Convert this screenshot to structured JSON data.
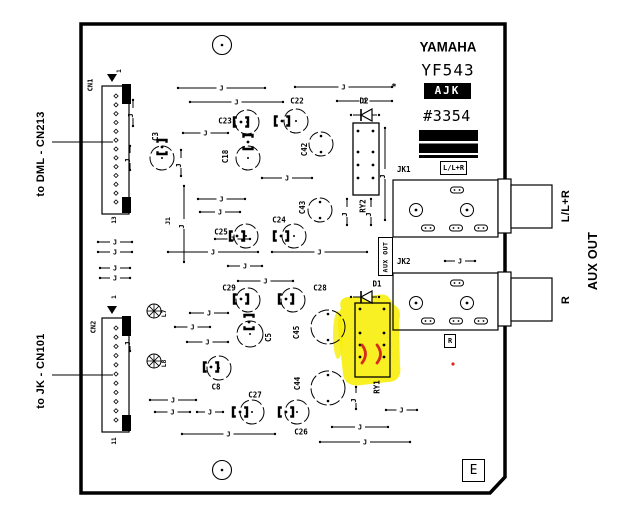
{
  "title_block": {
    "brand": "YAMAHA",
    "model": "YF543",
    "code": "AJK",
    "number": "#3354"
  },
  "board": {
    "revision": "E",
    "aux_out_box": "AUX OUT",
    "asterisk": "*"
  },
  "external_labels": {
    "left_top": "to DML - CN213",
    "left_bottom": "to JK - CN101",
    "right_jack1": "L/L+R",
    "right_jack2": "R",
    "right_group": "AUX OUT"
  },
  "jacks": [
    {
      "name": "JK1",
      "signal": "L/L+R",
      "x": 393,
      "y": 180,
      "w": 105,
      "h": 57
    },
    {
      "name": "JK2",
      "signal": "R",
      "x": 393,
      "y": 273,
      "w": 105,
      "h": 57
    }
  ],
  "connectors": [
    {
      "name": "CN1",
      "first_pin": "1",
      "last_pin": "13",
      "pins": 13,
      "x": 102,
      "y": 86,
      "w": 27,
      "h": 128
    },
    {
      "name": "CN2",
      "first_pin": "1",
      "last_pin": "11",
      "pins": 11,
      "x": 102,
      "y": 318,
      "w": 27,
      "h": 114
    }
  ],
  "relays": [
    {
      "label": "RY1",
      "x": 355,
      "y": 303,
      "w": 35,
      "h": 74,
      "cols": [
        360,
        384
      ],
      "rows": [
        309,
        333,
        345,
        357
      ]
    },
    {
      "label": "RY2",
      "x": 353,
      "y": 123,
      "w": 26,
      "h": 72,
      "cols": [
        358,
        373
      ],
      "rows": [
        131,
        152,
        165,
        178
      ]
    }
  ],
  "diodes": [
    {
      "label": "D1",
      "cx": 365,
      "cy": 297
    },
    {
      "label": "D2",
      "cx": 365,
      "cy": 115
    }
  ],
  "inductors": [
    {
      "label": "L7",
      "cx": 154,
      "cy": 311
    },
    {
      "label": "L8",
      "cx": 154,
      "cy": 361
    }
  ],
  "capacitors": [
    {
      "label": "C3",
      "cx": 162,
      "cy": 158,
      "r": 12,
      "lx": 158,
      "ly": 134,
      "lr": -90,
      "bx": 162,
      "by": 147,
      "br": 90,
      "d": "c"
    },
    {
      "label": "C23",
      "cx": 247,
      "cy": 122,
      "r": 12,
      "lx": 225,
      "ly": 121,
      "lr": 0,
      "bx": 241,
      "by": 122,
      "br": 0,
      "d": "c"
    },
    {
      "label": "C22",
      "cx": 296,
      "cy": 121,
      "r": 12,
      "lx": 297,
      "ly": 101,
      "lr": 0,
      "bx": 282,
      "by": 121,
      "br": 0,
      "d": "c"
    },
    {
      "label": "C18",
      "cx": 248,
      "cy": 158,
      "r": 12,
      "lx": 228,
      "ly": 154,
      "lr": -90,
      "bx": 248,
      "by": 142,
      "br": 90,
      "d": "c"
    },
    {
      "label": "C42",
      "cx": 321,
      "cy": 144,
      "r": 12,
      "lx": 307,
      "ly": 147,
      "lr": -90,
      "d": "tb"
    },
    {
      "label": "C24",
      "cx": 294,
      "cy": 236,
      "r": 12,
      "lx": 279,
      "ly": 220,
      "lr": 0,
      "bx": 281,
      "by": 236,
      "br": 0,
      "d": "c"
    },
    {
      "label": "C25",
      "cx": 246,
      "cy": 236,
      "r": 12,
      "lx": 221,
      "ly": 232,
      "lr": 0,
      "bx": 237,
      "by": 236,
      "br": 0,
      "d": "c"
    },
    {
      "label": "C43",
      "cx": 320,
      "cy": 210,
      "r": 12,
      "lx": 305,
      "ly": 205,
      "lr": -90,
      "d": "tb"
    },
    {
      "label": "C29",
      "cx": 248,
      "cy": 300,
      "r": 12,
      "lx": 229,
      "ly": 288,
      "lr": 0,
      "bx": 241,
      "by": 299,
      "br": 0,
      "d": "c"
    },
    {
      "label": "C28",
      "cx": 293,
      "cy": 300,
      "r": 12,
      "lx": 320,
      "ly": 288,
      "lr": 0,
      "bx": 286,
      "by": 299,
      "br": 0,
      "d": "c"
    },
    {
      "label": "C5",
      "cx": 250,
      "cy": 334,
      "r": 13,
      "lx": 271,
      "ly": 335,
      "lr": -90,
      "bx": 249,
      "by": 322,
      "br": 90,
      "d": "c"
    },
    {
      "label": "C45",
      "cx": 328,
      "cy": 327,
      "r": 17,
      "lx": 299,
      "ly": 330,
      "lr": -90,
      "d": "tb"
    },
    {
      "label": "C8",
      "cx": 219,
      "cy": 368,
      "r": 12,
      "lx": 216,
      "ly": 387,
      "lr": 0,
      "bx": 211,
      "by": 367,
      "br": 0,
      "d": "c"
    },
    {
      "label": "C27",
      "cx": 252,
      "cy": 412,
      "r": 12,
      "lx": 255,
      "ly": 395,
      "lr": 0,
      "bx": 240,
      "by": 412,
      "br": 0,
      "d": "c"
    },
    {
      "label": "C26",
      "cx": 297,
      "cy": 412,
      "r": 12,
      "lx": 301,
      "ly": 432,
      "lr": 0,
      "bx": 286,
      "by": 412,
      "br": 0,
      "d": "c"
    },
    {
      "label": "C44",
      "cx": 328,
      "cy": 388,
      "r": 17,
      "lx": 300,
      "ly": 381,
      "lr": -90,
      "d": "tb"
    }
  ],
  "jumper_glyph": "J",
  "wire": {
    "j1": "J1"
  },
  "jumpers": [
    {
      "o": "h",
      "x1": 178,
      "x2": 265,
      "y": 88
    },
    {
      "o": "h",
      "x1": 295,
      "x2": 392,
      "y": 87
    },
    {
      "o": "h",
      "x1": 190,
      "x2": 283,
      "y": 102
    },
    {
      "o": "h",
      "x1": 337,
      "x2": 392,
      "y": 101
    },
    {
      "o": "h",
      "x1": 183,
      "x2": 228,
      "y": 133
    },
    {
      "o": "h",
      "x1": 262,
      "x2": 312,
      "y": 178
    },
    {
      "o": "h",
      "x1": 198,
      "x2": 245,
      "y": 199
    },
    {
      "o": "h",
      "x1": 200,
      "x2": 240,
      "y": 212
    },
    {
      "o": "h",
      "x1": 215,
      "x2": 250,
      "y": 239
    },
    {
      "o": "h",
      "x1": 168,
      "x2": 258,
      "y": 252
    },
    {
      "o": "h",
      "x1": 272,
      "x2": 367,
      "y": 252
    },
    {
      "o": "h",
      "x1": 228,
      "x2": 262,
      "y": 266
    },
    {
      "o": "h",
      "x1": 238,
      "x2": 293,
      "y": 281
    },
    {
      "o": "h",
      "x1": 98,
      "x2": 132,
      "y": 242
    },
    {
      "o": "h",
      "x1": 98,
      "x2": 132,
      "y": 252
    },
    {
      "o": "h",
      "x1": 100,
      "x2": 130,
      "y": 268
    },
    {
      "o": "h",
      "x1": 100,
      "x2": 130,
      "y": 278
    },
    {
      "o": "h",
      "x1": 190,
      "x2": 228,
      "y": 313
    },
    {
      "o": "h",
      "x1": 175,
      "x2": 210,
      "y": 327
    },
    {
      "o": "h",
      "x1": 187,
      "x2": 228,
      "y": 342
    },
    {
      "o": "h",
      "x1": 150,
      "x2": 196,
      "y": 400
    },
    {
      "o": "h",
      "x1": 155,
      "x2": 190,
      "y": 412
    },
    {
      "o": "h",
      "x1": 197,
      "x2": 223,
      "y": 412
    },
    {
      "o": "h",
      "x1": 182,
      "x2": 275,
      "y": 434
    },
    {
      "o": "h",
      "x1": 386,
      "x2": 417,
      "y": 410
    },
    {
      "o": "h",
      "x1": 332,
      "x2": 388,
      "y": 427
    },
    {
      "o": "h",
      "x1": 320,
      "x2": 410,
      "y": 442
    },
    {
      "o": "h",
      "x1": 445,
      "x2": 475,
      "y": 261
    },
    {
      "o": "v",
      "x": 133,
      "y1": 100,
      "y2": 126
    },
    {
      "o": "v",
      "x": 130,
      "y1": 146,
      "y2": 170
    },
    {
      "o": "v",
      "x": 181,
      "y1": 150,
      "y2": 176
    },
    {
      "o": "v",
      "x": 184,
      "y1": 186,
      "y2": 262
    },
    {
      "o": "v",
      "x": 347,
      "y1": 199,
      "y2": 225
    },
    {
      "o": "v",
      "x": 371,
      "y1": 199,
      "y2": 225
    },
    {
      "o": "v",
      "x": 385,
      "y1": 128,
      "y2": 220
    },
    {
      "o": "v",
      "x": 356,
      "y1": 387,
      "y2": 409
    },
    {
      "o": "v",
      "x": 130,
      "y1": 331,
      "y2": 351
    }
  ],
  "mounting_holes": [
    {
      "cx": 222,
      "cy": 45
    },
    {
      "cx": 222,
      "cy": 470
    }
  ],
  "leader_lines": [
    {
      "x1": 52,
      "y1": 142,
      "x2": 113,
      "y2": 142
    },
    {
      "x1": 52,
      "y1": 375,
      "x2": 113,
      "y2": 375
    }
  ],
  "highlight": {
    "color": "#f8ee05",
    "marks_color": "#d92b1d"
  },
  "colors": {
    "line": "#000000",
    "badge_bg": "#000000",
    "badge_text": "#ffffff"
  }
}
